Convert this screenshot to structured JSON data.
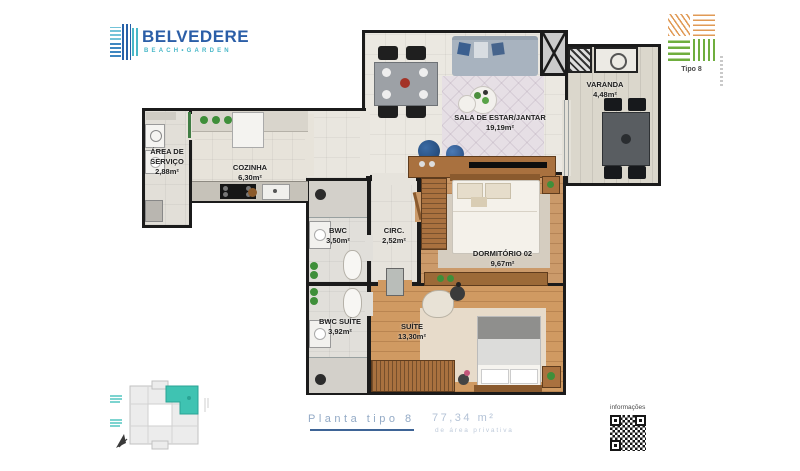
{
  "brand": {
    "name": "BELVEDERE",
    "tagline": "BEACH•GARDEN"
  },
  "unit_badge": {
    "label": "Tipo 8"
  },
  "rooms": {
    "area_servico": {
      "name": "ÁREA DE SERVIÇO",
      "area": "2,88m²"
    },
    "cozinha": {
      "name": "COZINHA",
      "area": "6,30m²"
    },
    "sala": {
      "name": "SALA DE ESTAR/JANTAR",
      "area": "19,19m²"
    },
    "varanda": {
      "name": "VARANDA",
      "area": "4,48m²"
    },
    "bwc": {
      "name": "BWC",
      "area": "3,50m²"
    },
    "circ": {
      "name": "CIRC.",
      "area": "2,52m²"
    },
    "dormitorio02": {
      "name": "DORMITÓRIO 02",
      "area": "9,67m²"
    },
    "bwc_suite": {
      "name": "BWC SUÍTE",
      "area": "3,92m²"
    },
    "suite": {
      "name": "SUÍTE",
      "area": "13,30m²"
    }
  },
  "caption": {
    "title": "Planta tipo 8",
    "area": "77,34 m²",
    "subtitle": "de área privativa"
  },
  "qr": {
    "label": "informações"
  },
  "colors": {
    "brand_blue": "#2b5ea7",
    "brand_teal": "#49b8c8",
    "keyplan_highlight": "#3fc3b2",
    "caption_blue": "#93aac6",
    "underline_blue": "#3e6496",
    "badge_orange": "#e09a55",
    "badge_green": "#6fae3e",
    "wall": "#1b1b1b",
    "wood_floor": "#cb9a6a"
  }
}
